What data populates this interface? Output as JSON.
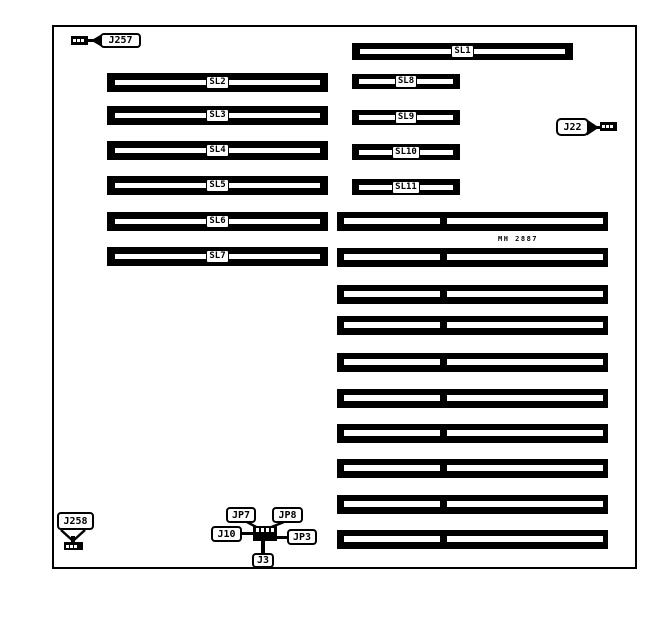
{
  "slots": {
    "sl1": "SL1",
    "sl2": "SL2",
    "sl3": "SL3",
    "sl4": "SL4",
    "sl5": "SL5",
    "sl6": "SL6",
    "sl7": "SL7",
    "sl8": "SL8",
    "sl9": "SL9",
    "sl10": "SL10",
    "sl11": "SL11"
  },
  "connectors": {
    "j257": "J257",
    "j22": "J22",
    "j258": "J258",
    "jp7": "JP7",
    "jp8": "JP8",
    "j10": "J10",
    "jp3": "JP3",
    "j3": "J3"
  },
  "part_number": "MH 2887",
  "colors": {
    "ink": "#000000",
    "paper": "#ffffff"
  }
}
